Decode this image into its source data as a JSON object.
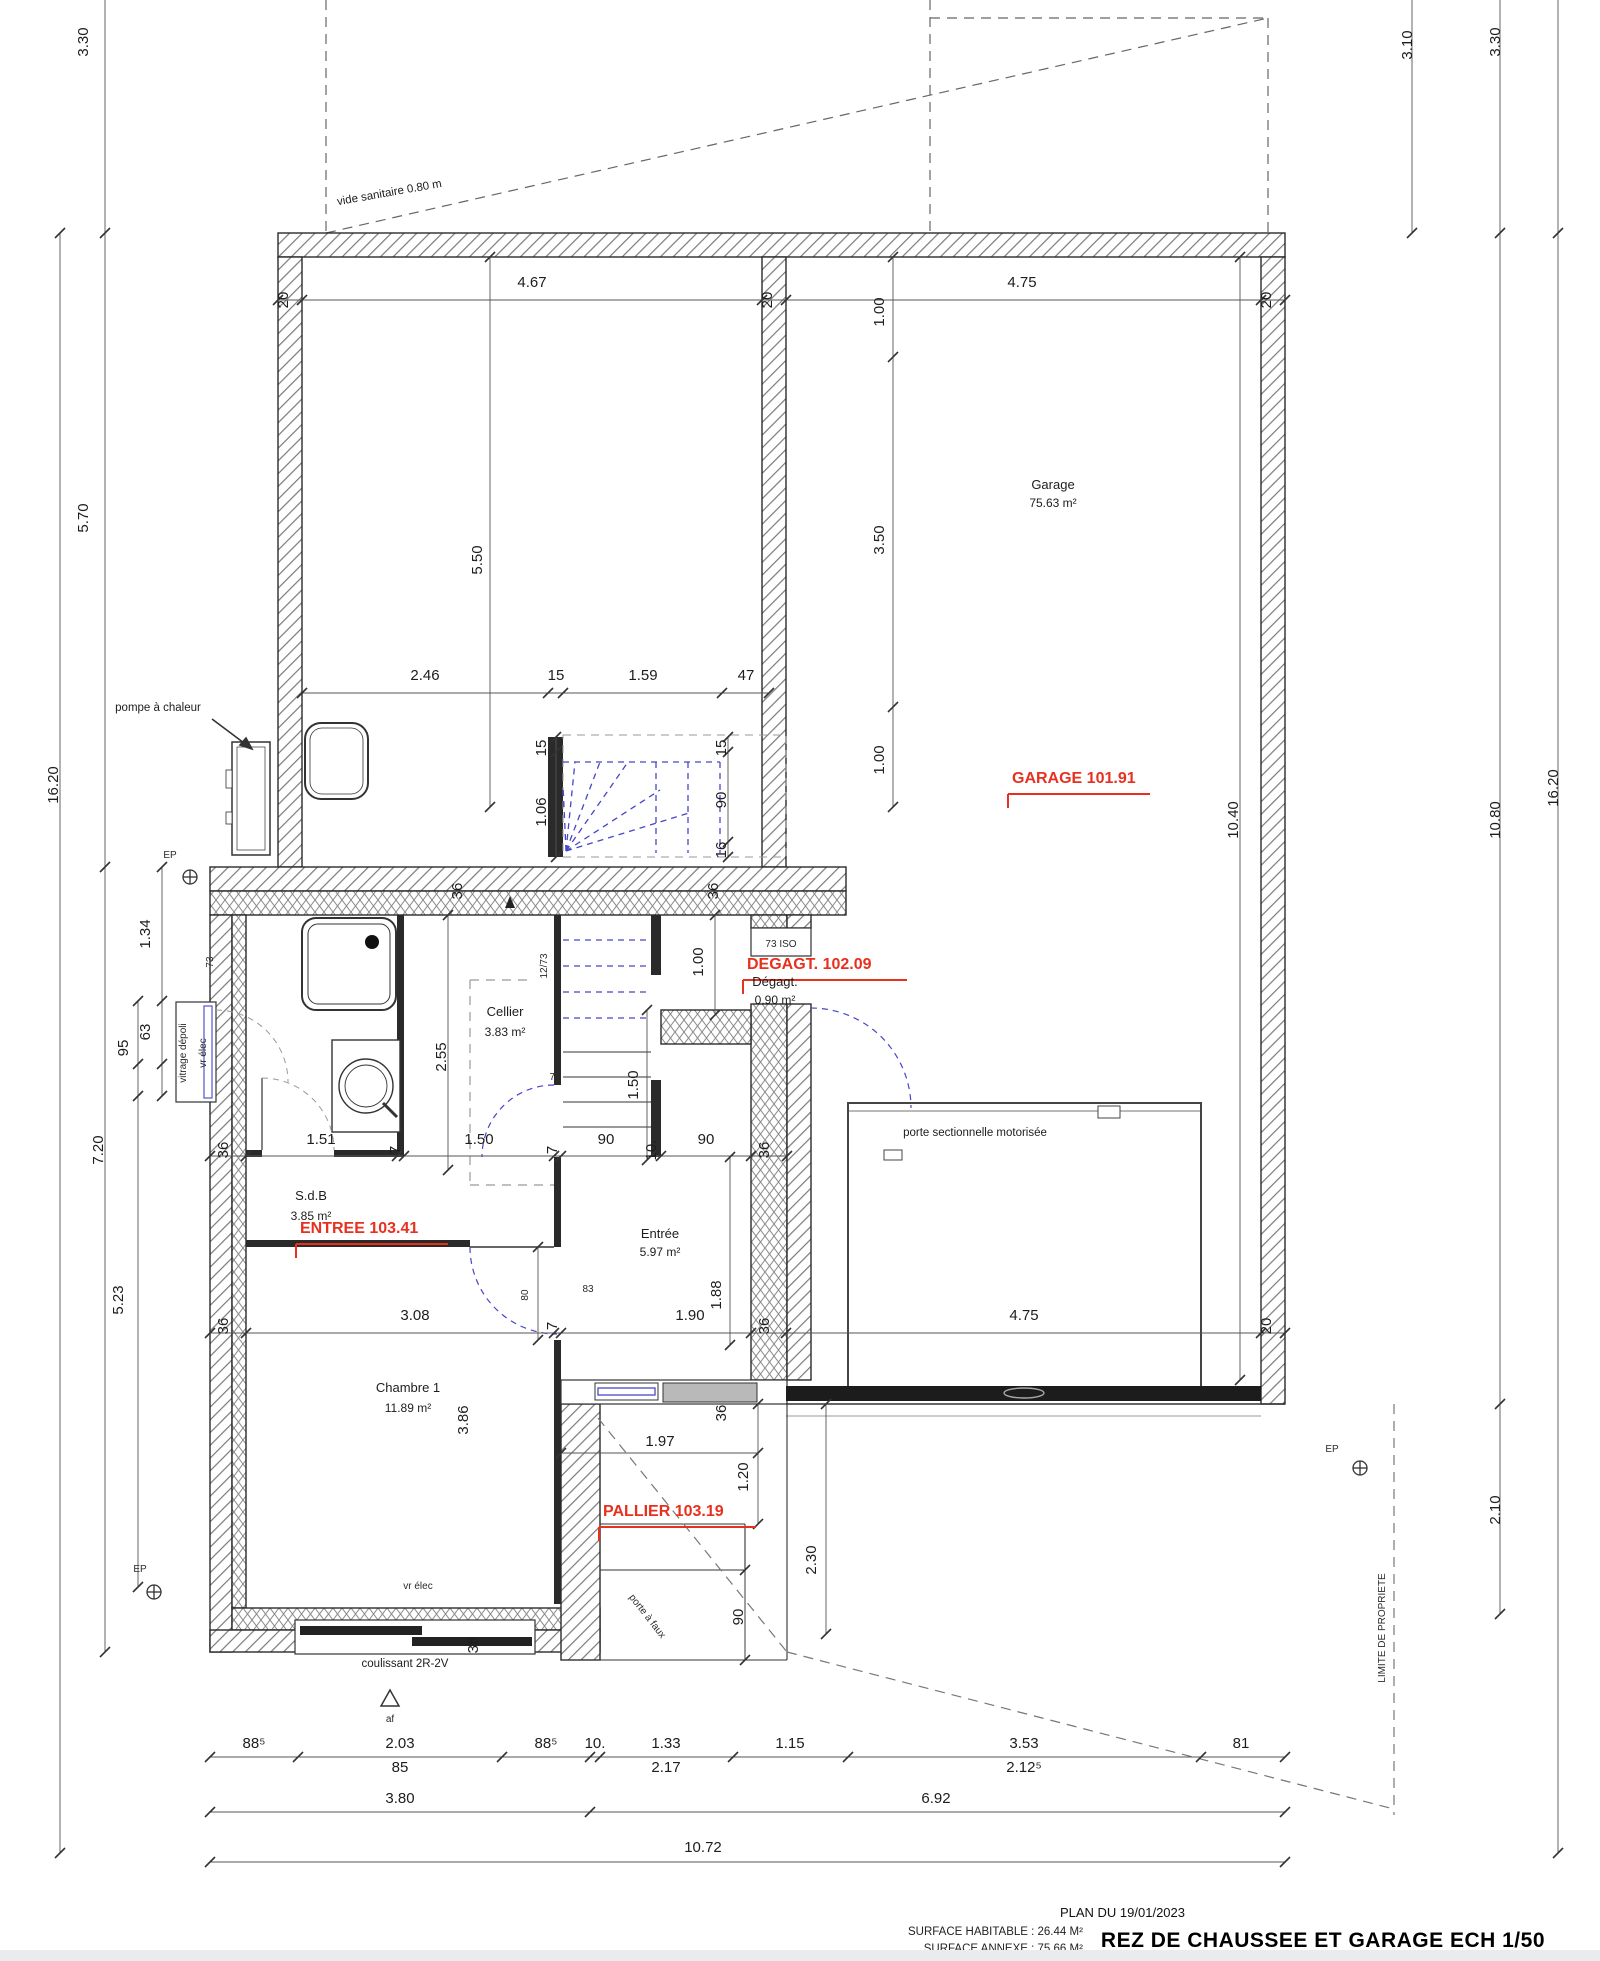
{
  "title_block": {
    "plan_date": "PLAN DU 19/01/2023",
    "surface_habitable": "SURFACE HABITABLE : 26.44 M²",
    "surface_annexe": "SURFACE ANNEXE : 75.66 M²",
    "title": "REZ DE CHAUSSEE ET GARAGE ECH 1/50"
  },
  "style": {
    "accent_red": "#e8301f",
    "stair_blue": "#4646c8",
    "wall_line": "#2a2a2a"
  },
  "rooms": [
    {
      "name": "Garage",
      "area": "75.63 m²"
    },
    {
      "name": "S.d.B",
      "area": "3.85 m²"
    },
    {
      "name": "Cellier",
      "area": "3.83 m²"
    },
    {
      "name": "Dégagt.",
      "area": "0.90 m²"
    },
    {
      "name": "Entrée",
      "area": "5.97 m²"
    },
    {
      "name": "Chambre 1",
      "area": "11.89 m²"
    }
  ],
  "levels": [
    "GARAGE 101.91",
    "DEGAGT. 102.09",
    "ENTREE 103.41",
    "PALLIER 103.19"
  ],
  "labels": [
    {
      "n": "dim-wall-20-top-left",
      "t": "20",
      "x": 288,
      "y": 300,
      "r": -90
    },
    {
      "n": "dim-4-67",
      "t": "4.67",
      "x": 532,
      "y": 287
    },
    {
      "n": "dim-wall-20-top-mid",
      "t": "20",
      "x": 772,
      "y": 300,
      "r": -90
    },
    {
      "n": "dim-4-75-top",
      "t": "4.75",
      "x": 1022,
      "y": 287
    },
    {
      "n": "dim-wall-20-top-right",
      "t": "20",
      "x": 1271,
      "y": 300,
      "r": -90
    },
    {
      "n": "dim-3-30-left",
      "t": "3.30",
      "x": 88,
      "y": 42,
      "r": -90
    },
    {
      "n": "dim-5-70-left",
      "t": "5.70",
      "x": 88,
      "y": 518,
      "r": -90
    },
    {
      "n": "dim-16-20-left",
      "t": "16.20",
      "x": 58,
      "y": 785,
      "r": -90
    },
    {
      "n": "dim-7-20-left",
      "t": "7.20",
      "x": 103,
      "y": 1150,
      "r": -90
    },
    {
      "n": "dim-1-34-left",
      "t": "1.34",
      "x": 150,
      "y": 934,
      "r": -90
    },
    {
      "n": "dim-63-left",
      "t": "63",
      "x": 150,
      "y": 1032,
      "r": -90
    },
    {
      "n": "dim-95-left",
      "t": "95",
      "x": 128,
      "y": 1048,
      "r": -90
    },
    {
      "n": "dim-5-23-left",
      "t": "5.23",
      "x": 123,
      "y": 1300,
      "r": -90
    },
    {
      "n": "dim-3-10-right",
      "t": "3.10",
      "x": 1412,
      "y": 45,
      "r": -90
    },
    {
      "n": "dim-3-30-right",
      "t": "3.30",
      "x": 1500,
      "y": 42,
      "r": -90
    },
    {
      "n": "dim-10-80-right",
      "t": "10.80",
      "x": 1500,
      "y": 820,
      "r": -90
    },
    {
      "n": "dim-16-20-right",
      "t": "16.20",
      "x": 1558,
      "y": 788,
      "r": -90
    },
    {
      "n": "dim-2-10-right",
      "t": "2.10",
      "x": 1500,
      "y": 1510,
      "r": -90
    },
    {
      "n": "dim-1-00-garage-top",
      "t": "1.00",
      "x": 884,
      "y": 312,
      "r": -90
    },
    {
      "n": "dim-3-50-garage",
      "t": "3.50",
      "x": 884,
      "y": 540,
      "r": -90
    },
    {
      "n": "dim-1-00-garage-mid",
      "t": "1.00",
      "x": 884,
      "y": 760,
      "r": -90
    },
    {
      "n": "dim-10-40-garage",
      "t": "10.40",
      "x": 1238,
      "y": 820,
      "r": -90
    },
    {
      "n": "dim-5-50-depot",
      "t": "5.50",
      "x": 482,
      "y": 560,
      "r": -90
    },
    {
      "n": "dim-2-46",
      "t": "2.46",
      "x": 425,
      "y": 680
    },
    {
      "n": "dim-15-row",
      "t": "15",
      "x": 556,
      "y": 680
    },
    {
      "n": "dim-1-59",
      "t": "1.59",
      "x": 643,
      "y": 680
    },
    {
      "n": "dim-47",
      "t": "47",
      "x": 746,
      "y": 680
    },
    {
      "n": "dim-15-stair-left",
      "t": "15",
      "x": 546,
      "y": 748,
      "r": -90
    },
    {
      "n": "dim-1-06-stair",
      "t": "1.06",
      "x": 546,
      "y": 812,
      "r": -90
    },
    {
      "n": "dim-15-stair-right",
      "t": "15",
      "x": 726,
      "y": 748,
      "r": -90
    },
    {
      "n": "dim-90-stair",
      "t": "90",
      "x": 726,
      "y": 800,
      "r": -90
    },
    {
      "n": "dim-16-stair",
      "t": "16",
      "x": 726,
      "y": 850,
      "r": -90
    },
    {
      "n": "dim-36-frontwall-a",
      "t": "36",
      "x": 462,
      "y": 891,
      "r": -90
    },
    {
      "n": "dim-36-frontwall-b",
      "t": "36",
      "x": 718,
      "y": 891,
      "r": -90
    },
    {
      "n": "dim-36-row2-left",
      "t": "36",
      "x": 228,
      "y": 1150,
      "r": -90
    },
    {
      "n": "dim-1-51",
      "t": "1.51",
      "x": 321,
      "y": 1144
    },
    {
      "n": "dim-7-row2-a",
      "t": "7",
      "x": 400,
      "y": 1150,
      "r": -90
    },
    {
      "n": "dim-1-50-row2",
      "t": "1.50",
      "x": 479,
      "y": 1144
    },
    {
      "n": "dim-7-row2-b",
      "t": "7",
      "x": 557,
      "y": 1150,
      "r": -90
    },
    {
      "n": "dim-90-row2-a",
      "t": "90",
      "x": 606,
      "y": 1144
    },
    {
      "n": "dim-10-row2",
      "t": "10.",
      "x": 656,
      "y": 1150,
      "r": -90
    },
    {
      "n": "dim-90-row2-b",
      "t": "90",
      "x": 706,
      "y": 1144
    },
    {
      "n": "dim-36-row2-right",
      "t": "36",
      "x": 769,
      "y": 1150,
      "r": -90
    },
    {
      "n": "dim-2-55-cellier",
      "t": "2.55",
      "x": 446,
      "y": 1057,
      "r": -90
    },
    {
      "n": "dim-1-00-degagt",
      "t": "1.00",
      "x": 703,
      "y": 962,
      "r": -90
    },
    {
      "n": "dim-1-50-stair-low",
      "t": "1.50",
      "x": 638,
      "y": 1085,
      "r": -90
    },
    {
      "n": "dim-1-88-entree",
      "t": "1.88",
      "x": 721,
      "y": 1295,
      "r": -90
    },
    {
      "n": "dim-80-door",
      "t": "80",
      "x": 528,
      "y": 1295,
      "r": -90,
      "c": "tiny"
    },
    {
      "n": "dim-3-86-chambre",
      "t": "3.86",
      "x": 468,
      "y": 1420,
      "r": -90
    },
    {
      "n": "dim-36-row3-left",
      "t": "36",
      "x": 228,
      "y": 1326,
      "r": -90
    },
    {
      "n": "dim-3-08",
      "t": "3.08",
      "x": 415,
      "y": 1320
    },
    {
      "n": "dim-7-row3",
      "t": "7",
      "x": 557,
      "y": 1326,
      "r": -90
    },
    {
      "n": "dim-1-90",
      "t": "1.90",
      "x": 690,
      "y": 1320
    },
    {
      "n": "dim-36-row3-right",
      "t": "36",
      "x": 769,
      "y": 1326,
      "r": -90
    },
    {
      "n": "dim-4-75-door",
      "t": "4.75",
      "x": 1024,
      "y": 1320
    },
    {
      "n": "dim-20-row3",
      "t": "20",
      "x": 1271,
      "y": 1326,
      "r": -90
    },
    {
      "n": "dim-1-97",
      "t": "1.97",
      "x": 660,
      "y": 1446
    },
    {
      "n": "dim-1-20",
      "t": "1.20",
      "x": 748,
      "y": 1477,
      "r": -90
    },
    {
      "n": "dim-2-30",
      "t": "2.30",
      "x": 816,
      "y": 1560,
      "r": -90
    },
    {
      "n": "dim-90-pallier",
      "t": "90",
      "x": 743,
      "y": 1617,
      "r": -90
    },
    {
      "n": "dim-36-entree-door",
      "t": "36",
      "x": 726,
      "y": 1413,
      "r": -90
    },
    {
      "n": "dim-36-bottom-wall",
      "t": "36",
      "x": 478,
      "y": 1645,
      "r": -90
    },
    {
      "n": "dim-88-5-a",
      "t": "88⁵",
      "x": 254,
      "y": 1748
    },
    {
      "n": "dim-2-03",
      "t": "2.03",
      "x": 400,
      "y": 1748
    },
    {
      "n": "dim-88-5-b",
      "t": "88⁵",
      "x": 546,
      "y": 1748
    },
    {
      "n": "dim-10-bottom",
      "t": "10.",
      "x": 595,
      "y": 1748
    },
    {
      "n": "dim-1-33",
      "t": "1.33",
      "x": 666,
      "y": 1748
    },
    {
      "n": "dim-1-15",
      "t": "1.15",
      "x": 790,
      "y": 1748
    },
    {
      "n": "dim-3-53",
      "t": "3.53",
      "x": 1024,
      "y": 1748
    },
    {
      "n": "dim-81",
      "t": "81",
      "x": 1241,
      "y": 1748
    },
    {
      "n": "dim-85",
      "t": "85",
      "x": 400,
      "y": 1772
    },
    {
      "n": "dim-2-17",
      "t": "2.17",
      "x": 666,
      "y": 1772
    },
    {
      "n": "dim-2-12-5",
      "t": "2.12⁵",
      "x": 1024,
      "y": 1772
    },
    {
      "n": "dim-3-80",
      "t": "3.80",
      "x": 400,
      "y": 1803
    },
    {
      "n": "dim-6-92",
      "t": "6.92",
      "x": 936,
      "y": 1803
    },
    {
      "n": "dim-10-72",
      "t": "10.72",
      "x": 703,
      "y": 1852
    },
    {
      "n": "room-label-garage",
      "t": "Garage",
      "x": 1053,
      "y": 489,
      "c": "room"
    },
    {
      "n": "area-label-garage",
      "t": "75.63 m²",
      "x": 1053,
      "y": 507,
      "c": "area"
    },
    {
      "n": "room-label-sdb",
      "t": "S.d.B",
      "x": 311,
      "y": 1200,
      "c": "room"
    },
    {
      "n": "area-label-sdb",
      "t": "3.85 m²",
      "x": 311,
      "y": 1220,
      "c": "area"
    },
    {
      "n": "room-label-cellier",
      "t": "Cellier",
      "x": 505,
      "y": 1016,
      "c": "room"
    },
    {
      "n": "area-label-cellier",
      "t": "3.83 m²",
      "x": 505,
      "y": 1036,
      "c": "area"
    },
    {
      "n": "room-label-degagt",
      "t": "Dégagt.",
      "x": 775,
      "y": 986,
      "c": "room"
    },
    {
      "n": "area-label-degagt",
      "t": "0.90 m²",
      "x": 775,
      "y": 1004,
      "c": "area"
    },
    {
      "n": "room-label-entree",
      "t": "Entrée",
      "x": 660,
      "y": 1238,
      "c": "room"
    },
    {
      "n": "area-label-entree",
      "t": "5.97 m²",
      "x": 660,
      "y": 1256,
      "c": "area"
    },
    {
      "n": "room-label-chambre1",
      "t": "Chambre 1",
      "x": 408,
      "y": 1392,
      "c": "room"
    },
    {
      "n": "area-label-chambre1",
      "t": "11.89 m²",
      "x": 408,
      "y": 1412,
      "c": "area"
    },
    {
      "n": "level-label-garage",
      "t": "GARAGE 101.91",
      "x": 1012,
      "y": 783,
      "c": "red"
    },
    {
      "n": "level-label-degagt",
      "t": "DEGAGT. 102.09",
      "x": 747,
      "y": 969,
      "c": "red"
    },
    {
      "n": "level-label-entree",
      "t": "ENTREE 103.41",
      "x": 300,
      "y": 1233,
      "c": "red"
    },
    {
      "n": "level-label-pallier",
      "t": "PALLIER 103.19",
      "x": 603,
      "y": 1516,
      "c": "red"
    },
    {
      "n": "note-vide-sanitaire",
      "t": "vide sanitaire 0.80 m",
      "x": 390,
      "y": 196,
      "r": -10,
      "c": "note"
    },
    {
      "n": "note-pompe-chaleur",
      "t": "pompe à chaleur",
      "x": 158,
      "y": 711,
      "c": "note"
    },
    {
      "n": "note-porte-sectionnelle",
      "t": "porte sectionnelle motorisée",
      "x": 975,
      "y": 1136,
      "c": "note"
    },
    {
      "n": "note-73-iso",
      "t": "73 ISO",
      "x": 781,
      "y": 947,
      "c": "tiny"
    },
    {
      "n": "note-12-73",
      "t": "12/73",
      "x": 547,
      "y": 966,
      "r": -90,
      "c": "tiny"
    },
    {
      "n": "note-73-entree",
      "t": "73",
      "x": 555,
      "y": 1080,
      "c": "tiny"
    },
    {
      "n": "note-73-left",
      "t": "73",
      "x": 213,
      "y": 962,
      "r": -90,
      "c": "tiny"
    },
    {
      "n": "note-83",
      "t": "83",
      "x": 588,
      "y": 1292,
      "c": "tiny"
    },
    {
      "n": "note-vitrage-depoli",
      "t": "vitrage dépoli",
      "x": 186,
      "y": 1053,
      "r": -90,
      "c": "tiny"
    },
    {
      "n": "note-vr-elec-sdb",
      "t": "vr élec",
      "x": 206,
      "y": 1053,
      "r": -90,
      "c": "tiny"
    },
    {
      "n": "note-vr-elec-chambre",
      "t": "vr élec",
      "x": 418,
      "y": 1589,
      "c": "tiny"
    },
    {
      "n": "note-coulissant",
      "t": "coulissant 2R-2V",
      "x": 405,
      "y": 1667,
      "c": "note"
    },
    {
      "n": "note-porte-a-faux",
      "t": "porte à faux",
      "x": 645,
      "y": 1618,
      "r": 52,
      "c": "tiny"
    },
    {
      "n": "note-limite-propriete",
      "t": "LIMITE DE PROPRIETE",
      "x": 1385,
      "y": 1628,
      "r": -90,
      "c": "tiny"
    },
    {
      "n": "note-ep-top-left",
      "t": "EP",
      "x": 170,
      "y": 858,
      "c": "tiny"
    },
    {
      "n": "note-ep-bottom-left",
      "t": "EP",
      "x": 140,
      "y": 1572,
      "c": "tiny"
    },
    {
      "n": "note-ep-bottom-right",
      "t": "EP",
      "x": 1332,
      "y": 1452,
      "c": "tiny"
    },
    {
      "n": "note-af",
      "t": "af",
      "x": 390,
      "y": 1722,
      "c": "tiny"
    }
  ]
}
